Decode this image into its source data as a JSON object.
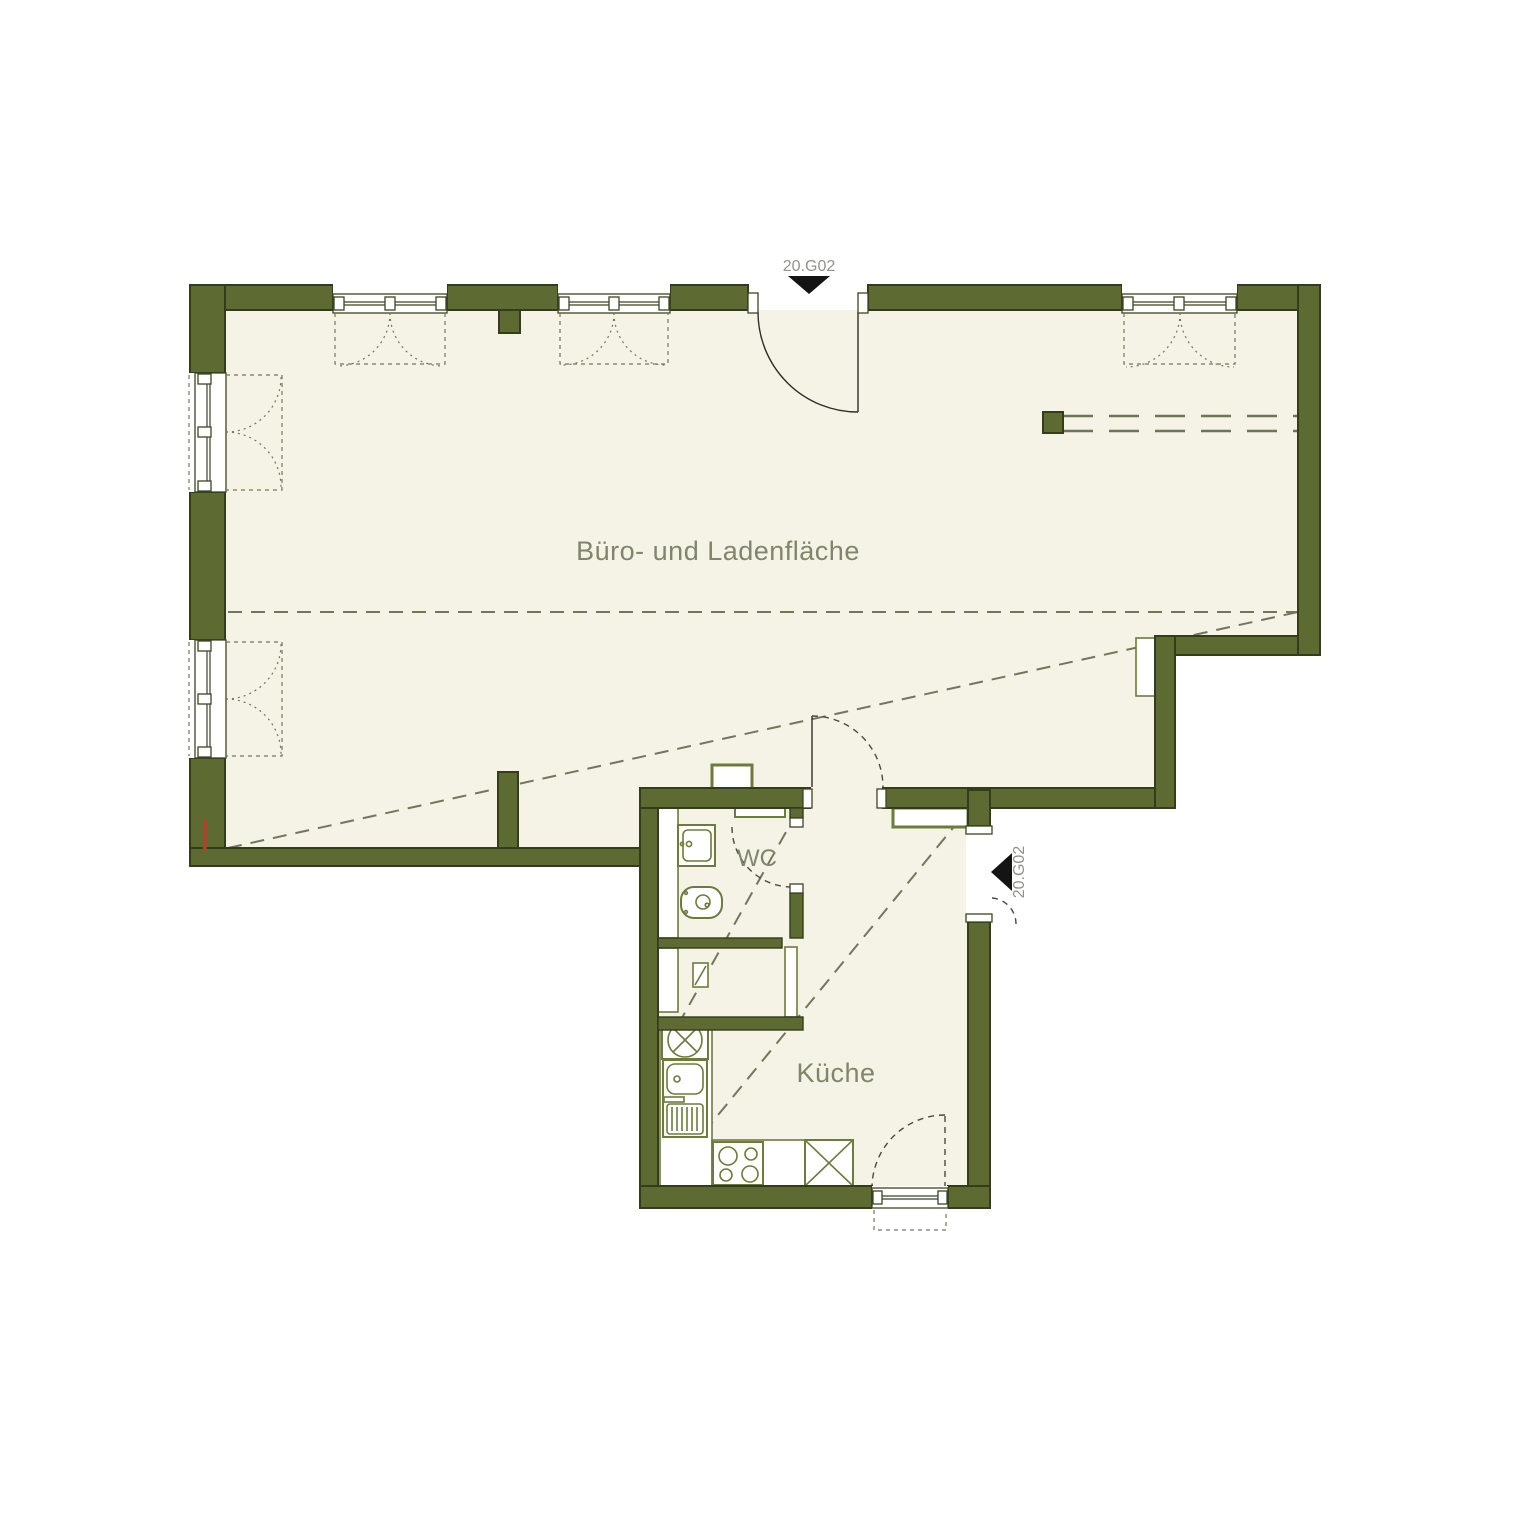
{
  "plan": {
    "title": "Floor plan unit 20.G02",
    "rooms": {
      "main": "Büro- und Ladenfläche",
      "wc": "WC",
      "kitchen": "Küche"
    },
    "entrances": {
      "top": "20.G02",
      "side": "20.G02"
    },
    "colors": {
      "wall": "#5d6b33",
      "wall_outline": "#333d1b",
      "floor": "#f4f3e6",
      "fixture_outline": "#6d7b3c",
      "dashed_guide": "#72775a",
      "room_label": "#80866a",
      "entrance_label": "#92928b",
      "entrance_arrow": "#111111",
      "section_marker": "#c0392b",
      "background": "#ffffff"
    }
  }
}
